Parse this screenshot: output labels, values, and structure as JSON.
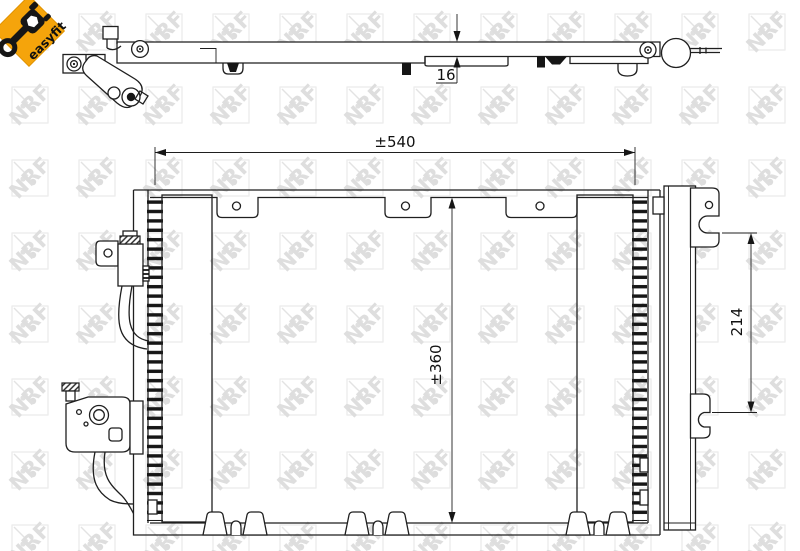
{
  "page": {
    "background": "#ffffff"
  },
  "badge": {
    "label": "easyfit",
    "color": "#f5a40b",
    "icon": "wrench-icon"
  },
  "watermark": {
    "text": "NRF"
  },
  "dimensions": {
    "top_view_thickness": "16",
    "front_width": "±540",
    "front_height": "±360",
    "side_mount_spacing": "214"
  },
  "colors": {
    "line": "#1f1f1f",
    "accent": "#f5a40b",
    "watermark_tint": "#e3e3e3"
  }
}
